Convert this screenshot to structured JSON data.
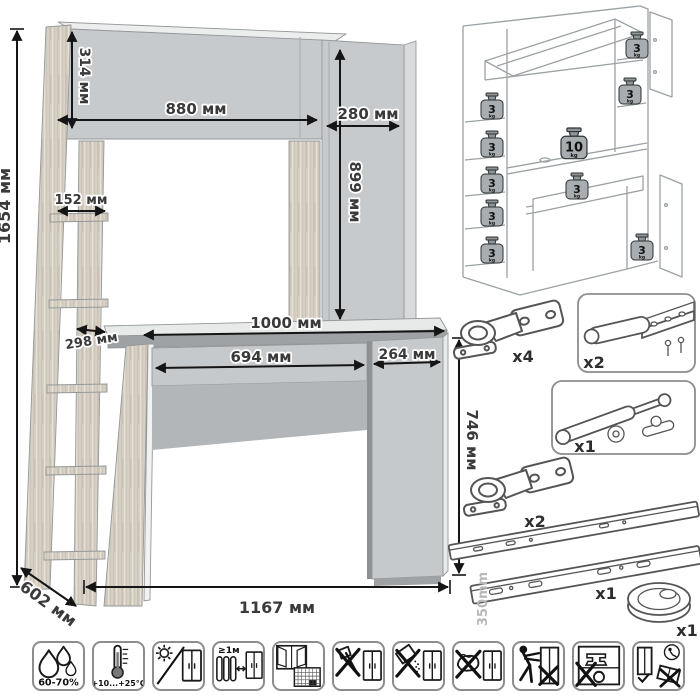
{
  "dimensions": {
    "total_height": "1654 мм",
    "hutch_height": "314 мм",
    "hutch_width": "880 мм",
    "top_cabinet_width": "280 мм",
    "top_cabinet_height": "899 мм",
    "shelf_width": "152 мм",
    "shelf_depth": "298 мм",
    "desktop_width": "1000 мм",
    "drawer_width": "694 мм",
    "pedestal_width": "264 мм",
    "desk_height": "746 мм",
    "depth": "602 мм",
    "total_width": "1167 мм"
  },
  "load_capacity": {
    "weights": [
      {
        "value": "3",
        "unit": "kg",
        "location": "hutch-top-shelf"
      },
      {
        "value": "3",
        "unit": "kg",
        "location": "right-upper-shelf"
      },
      {
        "value": "3",
        "unit": "kg",
        "location": "left-shelf-1"
      },
      {
        "value": "3",
        "unit": "kg",
        "location": "left-shelf-2"
      },
      {
        "value": "3",
        "unit": "kg",
        "location": "left-shelf-3"
      },
      {
        "value": "3",
        "unit": "kg",
        "location": "left-shelf-4"
      },
      {
        "value": "3",
        "unit": "kg",
        "location": "left-shelf-5"
      },
      {
        "value": "10",
        "unit": "kg",
        "location": "desktop"
      },
      {
        "value": "3",
        "unit": "kg",
        "location": "drawer"
      },
      {
        "value": "3",
        "unit": "kg",
        "location": "pedestal-cabinet"
      }
    ]
  },
  "hardware": {
    "items": [
      {
        "name": "concealed-hinge",
        "qty": "x4"
      },
      {
        "name": "push-latch-with-strike-plate",
        "qty": "x2"
      },
      {
        "name": "gas-lift-strut",
        "qty": "x1"
      },
      {
        "name": "concealed-hinge",
        "qty": "x2"
      },
      {
        "name": "drawer-slides",
        "qty": "x1",
        "length": "350mm"
      },
      {
        "name": "cable-grommet",
        "qty": "x1"
      }
    ]
  },
  "care_icons": [
    {
      "name": "humidity-range",
      "label": "60-70%"
    },
    {
      "name": "temperature-range",
      "label": "+10...+25°С"
    },
    {
      "name": "avoid-direct-sunlight",
      "label": ""
    },
    {
      "name": "keep-distance-from-heat",
      "label": "≥1м"
    },
    {
      "name": "ventilate-room",
      "label": "21"
    },
    {
      "name": "no-sharp-tools",
      "label": ""
    },
    {
      "name": "no-abrasive-cleaners",
      "label": ""
    },
    {
      "name": "no-wet-cleaning",
      "label": ""
    },
    {
      "name": "do-not-drag",
      "label": ""
    },
    {
      "name": "do-not-overload",
      "label": ""
    },
    {
      "name": "transport-store-upright",
      "label": ""
    }
  ]
}
